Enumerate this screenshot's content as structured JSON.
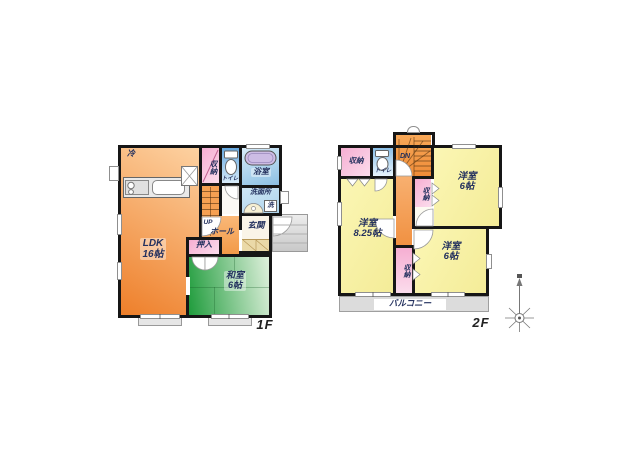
{
  "floor1": {
    "floor_label": "1F",
    "labels": {
      "fridge": "冷",
      "closet": "収納",
      "toilet": "トイレ",
      "bath": "浴室",
      "washroom": "洗面所",
      "washer": "洗",
      "up": "UP",
      "hall": "ホール",
      "entrance": "玄関",
      "oshiire": "押入",
      "ldk_name": "LDK",
      "ldk_size": "16帖",
      "washitsu_name": "和室",
      "washitsu_size": "6帖"
    }
  },
  "floor2": {
    "floor_label": "2F",
    "labels": {
      "closet_tl": "収納",
      "toilet": "トイレ",
      "down": "DN",
      "closet_mid": "収納",
      "closet_strip": "収納",
      "room_tr_name": "洋室",
      "room_tr_size": "6帖",
      "room_l_name": "洋室",
      "room_l_size": "8.25帖",
      "room_br_name": "洋室",
      "room_br_size": "6帖",
      "balcony": "バルコニー"
    }
  },
  "colors": {
    "wall": "#161616",
    "ldk_orange": "#F08A33",
    "tatami_green": "#2FA344",
    "western_yellow": "#F8F2A6",
    "closet_pink": "#F6AED2",
    "water_blue": "#A8D0EC",
    "tub_lavender": "#CDBCE4",
    "balcony_gray": "#DCDCDC",
    "label_navy": "#23305E"
  }
}
